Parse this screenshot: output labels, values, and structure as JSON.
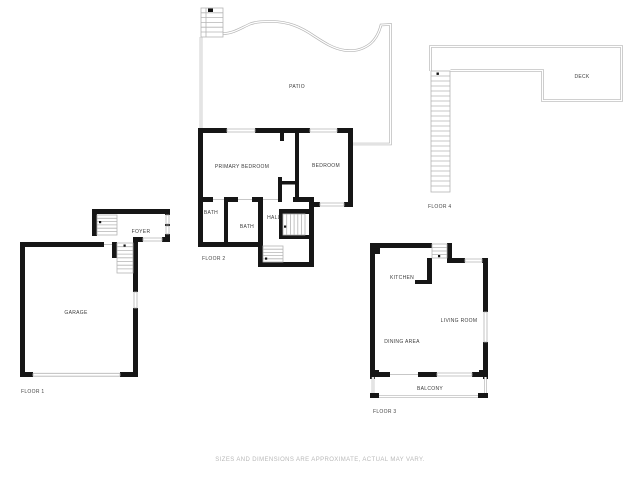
{
  "document": {
    "type": "floor-plan-sheet",
    "disclaimer": "SIZES AND DIMENSIONS ARE APPROXIMATE, ACTUAL MAY VARY.",
    "colors": {
      "wall": "#161616",
      "thin_line": "#b5b5b5",
      "label_text": "#3c3c3c",
      "disclaimer_text": "#b9b9b9",
      "background": "#ffffff"
    }
  },
  "floors": {
    "floor1": {
      "label": "FLOOR 1",
      "rooms": {
        "garage": "GARAGE",
        "foyer": "FOYER"
      }
    },
    "floor2": {
      "label": "FLOOR 2",
      "rooms": {
        "primary_bedroom": "PRIMARY BEDROOM",
        "bedroom": "BEDROOM",
        "bath1": "BATH",
        "bath2": "BATH",
        "hall": "HALL"
      },
      "outdoor": {
        "patio": "PATIO"
      }
    },
    "floor3": {
      "label": "FLOOR 3",
      "rooms": {
        "kitchen": "KITCHEN",
        "living_room": "LIVING ROOM",
        "dining_area": "DINING AREA",
        "balcony": "BALCONY"
      }
    },
    "floor4": {
      "label": "FLOOR 4",
      "rooms": {
        "deck": "DECK"
      }
    }
  }
}
